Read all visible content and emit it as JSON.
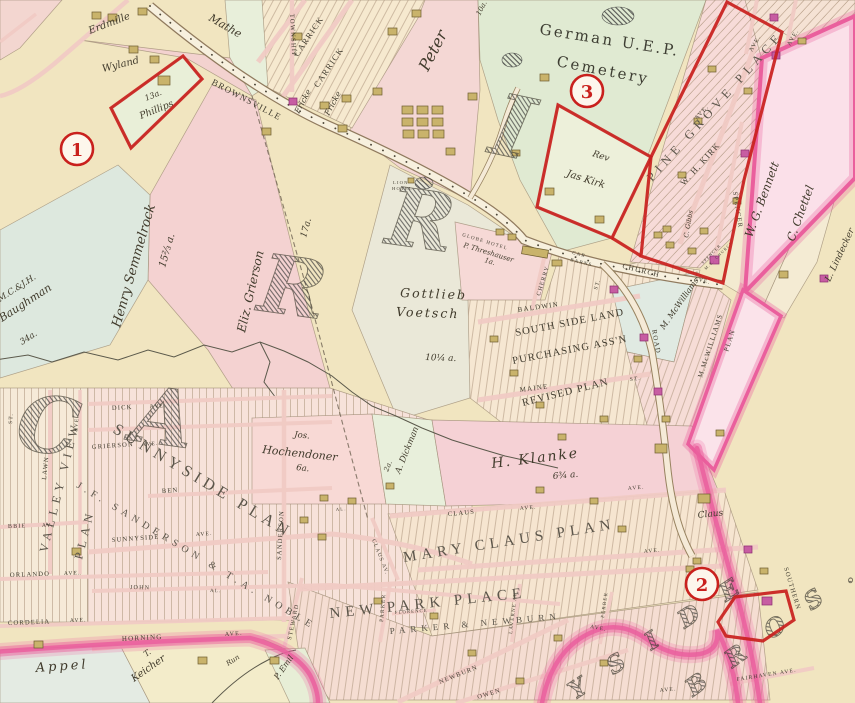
{
  "colors": {
    "annotation": "#c9201d",
    "parchment": "#f1e5c0",
    "plate_edge": "#ea5f9d",
    "parcel_pink": "#f5d3d3",
    "parcel_green": "#e0ead2",
    "building_tan": "#c9b36b",
    "building_magenta": "#c75da2"
  },
  "annotations": {
    "marker1": "1",
    "marker2": "2",
    "marker3": "3"
  },
  "labels": {
    "mathews": "Mathe",
    "erdmille": "Erdmille",
    "wyland": "Wyland",
    "phillips_acres": "13a.",
    "phillips": "Phillips",
    "brownsville": "BROWNSVILLE",
    "township": "TOWNSHIP",
    "carrick": "CARRICK",
    "fricke": "Fricke",
    "peter": "Peter",
    "peter_acres": "10a.",
    "cemetery_line1": "German U.E.P.",
    "cemetery_line2": "Cemetery",
    "lion_hotel_1": "LION",
    "lion_hotel_2": "HOTEL",
    "globe_hotel": "GLOBE HOTEL",
    "threshauser": "P. Threshauser",
    "threshauser_acres": "1a.",
    "car_barns_1": "CAR",
    "car_barns_2": "BARNS",
    "church": "CHURCH",
    "cherry": "CHERRY",
    "baldwin": "BALDWIN",
    "maine": "MAINE",
    "st": "ST.",
    "ave": "AVE.",
    "av": "AV.",
    "al": "AL.",
    "road": "ROAD",
    "ssl1": "SOUTH SIDE LAND",
    "ssl2": "PURCHASING ASS'N",
    "ssl3": "REVISED PLAN",
    "mcwilliams_owner": "M. McWilliams",
    "mcwilliams_plan1": "M.McWILLIAMS",
    "mcwilliams_plan2": "PLAN",
    "rev_kirk_1": "Rev",
    "rev_kirk_2": "Jas Kirk",
    "pine_grove": "PINE GROVE PLACE",
    "wh_kirk": "W. H. KIRK",
    "spencer": "SPENCER",
    "spencer_church_1": "SPENCER",
    "spencer_church_2": "M.E. CHURCH",
    "gibbs": "C. Gibbs",
    "bennett": "W. G. Bennett",
    "chettel": "C. Chettel",
    "lindecker": "L. Lindecker",
    "grierson_owner": "Eliz. Grierson",
    "grierson_acres": "17a.",
    "semmelrock": "Henry Semmelrock",
    "semmelrock_acres": "15⅔ a.",
    "baughman_1": "M.C.&J.H.",
    "baughman_2": "Baughman",
    "baughman_acres": "34a.",
    "voetsch_1": "Gottlieb",
    "voetsch_2": "Voetsch",
    "voetsch_acres": "10¼ a.",
    "hochendoner_1": "Jos.",
    "hochendoner_2": "Hochendoner",
    "hochendoner_acres": "6a.",
    "dickman": "A. Dickman",
    "dickman_acres": "2a.",
    "klanke": "H. Klanke",
    "klanke_acres": "6¾ a.",
    "sunnyside_plan": "SUNNYSIDE PLAN",
    "sanderson_noble": "J.F. SANDERSON & T.A. NOBLE",
    "valley_view": "VALLEY VIEW",
    "plan": "PLAN",
    "lawn": "LAWN",
    "dick": "DICK",
    "grierson_ave": "GRIERSON",
    "ben": "BEN",
    "sunnyside_ave": "SUNNYSIDE",
    "sanderson_st": "SANDERSON",
    "robbie": "BBIE",
    "orlando": "ORLANDO",
    "john": "JOHN",
    "cordelia": "CORDELIA",
    "horning": "HORNING",
    "claus_st": "CLAUS",
    "claus_av": "CLAUS AV.",
    "claus_parcel": "Claus",
    "mary_claus_plan": "MARY CLAUS PLAN",
    "new_park_place": "NEW PARK PLACE",
    "parker_newburn": "PARKER & NEWBURN",
    "parker": "PARKER",
    "steward": "STEWARD",
    "florence": "FLORENCE",
    "laverne": "LAVERNE AV.",
    "newburn": "NEWBURN",
    "owen": "OWEN",
    "fairhaven": "FAIRHAVEN AVE.",
    "southern": "SOUTHERN",
    "ferber": "FERBER",
    "keicher_1": "T.",
    "keicher_2": "Keicher",
    "appel": "Appel",
    "emil": "P. Emil",
    "run": "Run",
    "big_c": "C",
    "big_a": "A",
    "big_r": "R",
    "big_i": "I",
    "big_yside": "Y S I D E",
    "big_bros": "B R O S ."
  }
}
